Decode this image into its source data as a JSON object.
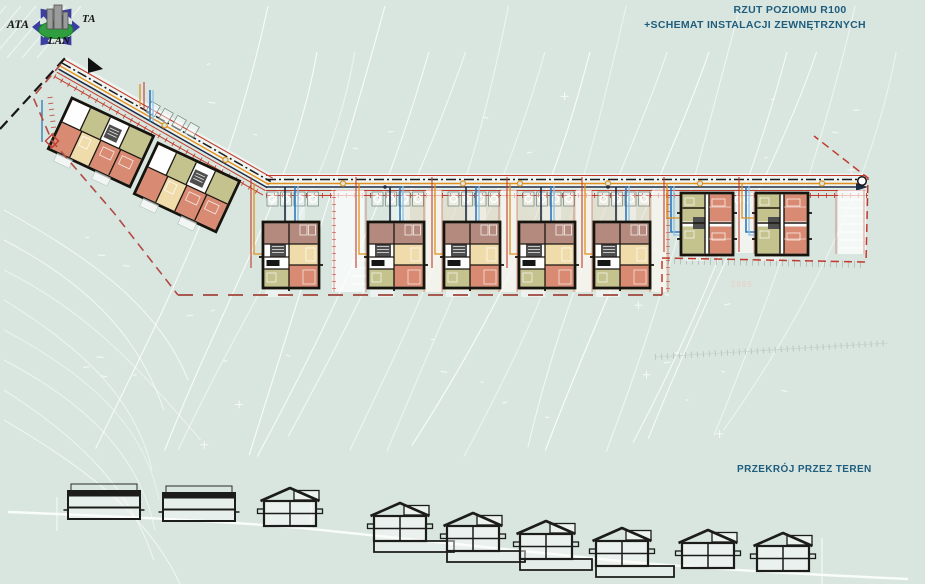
{
  "header": {
    "title_line1": "RZUT POZIOMU R100",
    "title_line2": "+SCHEMAT INSTALACJI ZEWNĘTRZNYCH"
  },
  "section": {
    "label": "PRZEKRÓJ PRZEZ TEREN"
  },
  "logo": {
    "text_left": "ATA",
    "text_right": "TA",
    "text_bottom": "LAN"
  },
  "plan": {
    "elevation_label": "2065"
  },
  "palette": {
    "bg": "#d9e6e0",
    "contour": "#ffffff",
    "title": "#1f5d7d",
    "road-red": "#c23b2a",
    "road-orange": "#e2901c",
    "navy": "#1d2b45",
    "pipe-blue": "#2d78bd",
    "pipe-blue-light": "#8ec2e8",
    "boundary-red": "#b14a40",
    "room-mauve": "#b58a7e",
    "room-cream": "#f0dcab",
    "room-salmon": "#d98a72",
    "room-olive": "#c4c28d",
    "room-gray": "#4e4e4e",
    "tan": "#e5d9bf",
    "logo-blue": "#3c3f9f",
    "logo-green": "#2f9e3f"
  }
}
